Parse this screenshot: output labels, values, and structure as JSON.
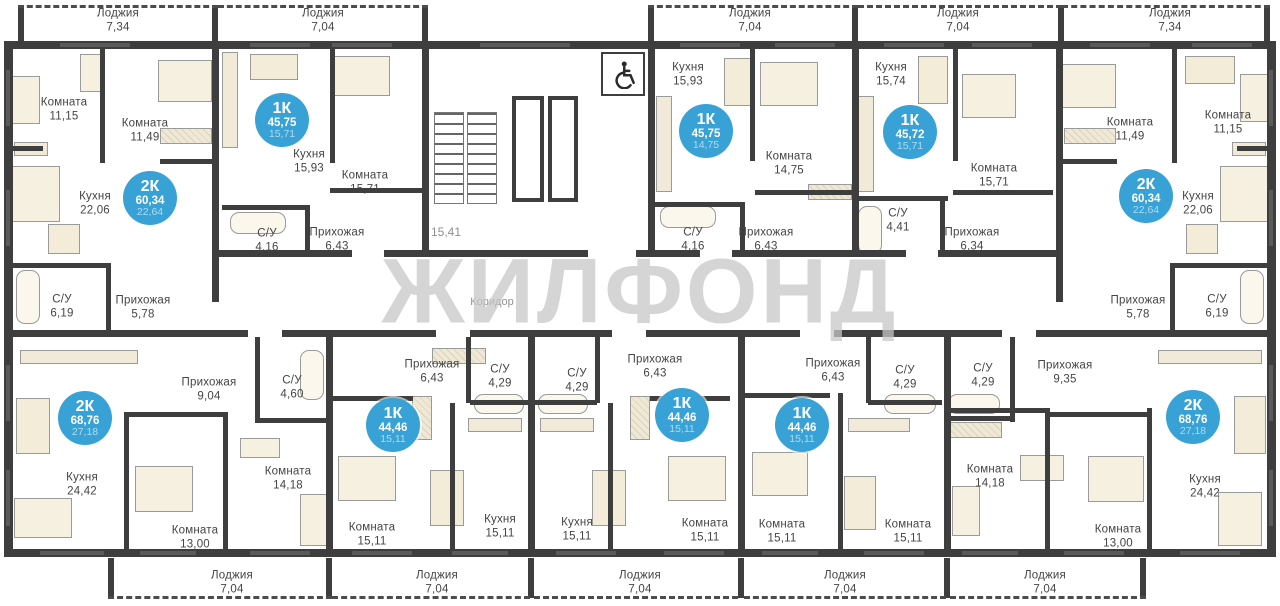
{
  "watermark": {
    "text": "ЖИЛФОНД"
  },
  "common": {
    "corridor_label": "Коридор",
    "stair_area_label": "15,41",
    "wheelchair_icon": "wheelchair-accessible"
  },
  "colors": {
    "badge_bg": "#38a2d6",
    "badge_living_text": "rgba(255,255,255,0.6)",
    "wall": "#3e3e3e",
    "label_text": "#454545",
    "furniture_fill": "#f6f0e0",
    "watermark": "#c7c7c7",
    "floor": "#ffffff"
  },
  "apartments": [
    {
      "label": "2К",
      "total": "60,34",
      "living": "22,64",
      "badge": {
        "x": 150,
        "y": 198
      },
      "loggia": {
        "name": "Лоджия",
        "area": "7,34",
        "x": 118,
        "y": 21
      },
      "rooms": [
        {
          "name": "Комната",
          "area": "11,15",
          "x": 64,
          "y": 110
        },
        {
          "name": "Комната",
          "area": "11,49",
          "x": 145,
          "y": 131
        },
        {
          "name": "Кухня",
          "area": "22,06",
          "x": 95,
          "y": 204
        },
        {
          "name": "С/У",
          "area": "6,19",
          "x": 62,
          "y": 307
        },
        {
          "name": "Прихожая",
          "area": "5,78",
          "x": 143,
          "y": 308
        }
      ]
    },
    {
      "label": "1К",
      "total": "45,75",
      "living": "15,71",
      "badge": {
        "x": 282,
        "y": 120
      },
      "loggia": {
        "name": "Лоджия",
        "area": "7,04",
        "x": 323,
        "y": 21
      },
      "rooms": [
        {
          "name": "Кухня",
          "area": "15,93",
          "x": 309,
          "y": 162
        },
        {
          "name": "Комната",
          "area": "15,71",
          "x": 365,
          "y": 183
        },
        {
          "name": "С/У",
          "area": "4,16",
          "x": 267,
          "y": 241
        },
        {
          "name": "Прихожая",
          "area": "6,43",
          "x": 337,
          "y": 240
        }
      ]
    },
    {
      "label": "1К",
      "total": "45,75",
      "living": "14,75",
      "badge": {
        "x": 706,
        "y": 131
      },
      "loggia": {
        "name": "Лоджия",
        "area": "7,04",
        "x": 750,
        "y": 21
      },
      "rooms": [
        {
          "name": "Кухня",
          "area": "15,93",
          "x": 688,
          "y": 75
        },
        {
          "name": "Комната",
          "area": "14,75",
          "x": 789,
          "y": 164
        },
        {
          "name": "С/У",
          "area": "4,16",
          "x": 693,
          "y": 240
        },
        {
          "name": "Прихожая",
          "area": "6,43",
          "x": 766,
          "y": 240
        }
      ]
    },
    {
      "label": "1К",
      "total": "45,72",
      "living": "15,71",
      "badge": {
        "x": 910,
        "y": 132
      },
      "loggia": {
        "name": "Лоджия",
        "area": "7,04",
        "x": 958,
        "y": 21
      },
      "rooms": [
        {
          "name": "Кухня",
          "area": "15,74",
          "x": 891,
          "y": 75
        },
        {
          "name": "Комната",
          "area": "15,71",
          "x": 994,
          "y": 176
        },
        {
          "name": "С/У",
          "area": "4,41",
          "x": 898,
          "y": 221
        },
        {
          "name": "Прихожая",
          "area": "6,34",
          "x": 972,
          "y": 240
        }
      ]
    },
    {
      "label": "2К",
      "total": "60,34",
      "living": "22,64",
      "badge": {
        "x": 1146,
        "y": 196
      },
      "loggia": {
        "name": "Лоджия",
        "area": "7,34",
        "x": 1170,
        "y": 21
      },
      "rooms": [
        {
          "name": "Комната",
          "area": "11,49",
          "x": 1130,
          "y": 130
        },
        {
          "name": "Комната",
          "area": "11,15",
          "x": 1228,
          "y": 123
        },
        {
          "name": "Кухня",
          "area": "22,06",
          "x": 1198,
          "y": 204
        },
        {
          "name": "Прихожая",
          "area": "5,78",
          "x": 1138,
          "y": 308
        },
        {
          "name": "С/У",
          "area": "6,19",
          "x": 1217,
          "y": 307
        }
      ]
    },
    {
      "label": "2К",
      "total": "68,76",
      "living": "27,18",
      "badge": {
        "x": 85,
        "y": 418
      },
      "loggia": {
        "name": "Лоджия",
        "area": "7,04",
        "x": 232,
        "y": 583
      },
      "rooms": [
        {
          "name": "Прихожая",
          "area": "9,04",
          "x": 209,
          "y": 390
        },
        {
          "name": "С/У",
          "area": "4,60",
          "x": 292,
          "y": 388
        },
        {
          "name": "Кухня",
          "area": "24,42",
          "x": 82,
          "y": 485
        },
        {
          "name": "Комната",
          "area": "13,00",
          "x": 195,
          "y": 538
        },
        {
          "name": "Комната",
          "area": "14,18",
          "x": 288,
          "y": 479
        }
      ]
    },
    {
      "label": "1К",
      "total": "44,46",
      "living": "15,11",
      "badge": {
        "x": 393,
        "y": 425
      },
      "loggia": {
        "name": "Лоджия",
        "area": "7,04",
        "x": 437,
        "y": 583
      },
      "rooms": [
        {
          "name": "Прихожая",
          "area": "6,43",
          "x": 432,
          "y": 372
        },
        {
          "name": "С/У",
          "area": "4,29",
          "x": 500,
          "y": 377
        },
        {
          "name": "Комната",
          "area": "15,11",
          "x": 372,
          "y": 535
        },
        {
          "name": "Кухня",
          "area": "15,11",
          "x": 500,
          "y": 527
        }
      ]
    },
    {
      "label": "1К",
      "total": "44,46",
      "living": "15,11",
      "badge": {
        "x": 682,
        "y": 415
      },
      "loggia": {
        "name": "Лоджия",
        "area": "7,04",
        "x": 640,
        "y": 583
      },
      "rooms": [
        {
          "name": "С/У",
          "area": "4,29",
          "x": 577,
          "y": 381
        },
        {
          "name": "Кухня",
          "area": "15,11",
          "x": 577,
          "y": 530
        },
        {
          "name": "Прихожая",
          "area": "6,43",
          "x": 655,
          "y": 367
        },
        {
          "name": "Комната",
          "area": "15,11",
          "x": 705,
          "y": 531
        }
      ]
    },
    {
      "label": "1К",
      "total": "44,46",
      "living": "15,11",
      "badge": {
        "x": 802,
        "y": 425
      },
      "loggia": {
        "name": "Лоджия",
        "area": "7,04",
        "x": 845,
        "y": 583
      },
      "rooms": [
        {
          "name": "Прихожая",
          "area": "6,43",
          "x": 833,
          "y": 371
        },
        {
          "name": "С/У",
          "area": "4,29",
          "x": 905,
          "y": 378
        },
        {
          "name": "Комната",
          "area": "15,11",
          "x": 782,
          "y": 532
        },
        {
          "name": "Комната",
          "area": "15,11",
          "x": 908,
          "y": 532
        }
      ]
    },
    {
      "label": "2К",
      "total": "68,76",
      "living": "27,18",
      "badge": {
        "x": 1193,
        "y": 417
      },
      "loggia": {
        "name": "Лоджия",
        "area": "7,04",
        "x": 1045,
        "y": 583
      },
      "rooms": [
        {
          "name": "С/У",
          "area": "4,29",
          "x": 983,
          "y": 376
        },
        {
          "name": "Прихожая",
          "area": "9,35",
          "x": 1065,
          "y": 373
        },
        {
          "name": "Комната",
          "area": "14,18",
          "x": 990,
          "y": 477
        },
        {
          "name": "Комната",
          "area": "13,00",
          "x": 1118,
          "y": 537
        },
        {
          "name": "Кухня",
          "area": "24,42",
          "x": 1205,
          "y": 487
        }
      ]
    }
  ],
  "furniture": [
    {
      "kind": "bed",
      "x": 12,
      "y": 76,
      "w": 28,
      "h": 48
    },
    {
      "kind": "bed",
      "x": 158,
      "y": 60,
      "w": 54,
      "h": 42
    },
    {
      "kind": "wardrobe",
      "x": 160,
      "y": 128,
      "w": 52,
      "h": 16
    },
    {
      "kind": "desk",
      "x": 80,
      "y": 54,
      "w": 22,
      "h": 38
    },
    {
      "kind": "counter",
      "x": 14,
      "y": 142,
      "w": 34,
      "h": 14
    },
    {
      "kind": "sofa",
      "x": 12,
      "y": 166,
      "w": 48,
      "h": 56
    },
    {
      "kind": "table",
      "x": 48,
      "y": 224,
      "w": 32,
      "h": 30
    },
    {
      "kind": "bath",
      "x": 16,
      "y": 270,
      "w": 24,
      "h": 54
    },
    {
      "kind": "counter",
      "x": 222,
      "y": 52,
      "w": 16,
      "h": 96
    },
    {
      "kind": "table",
      "x": 250,
      "y": 54,
      "w": 48,
      "h": 26
    },
    {
      "kind": "bed",
      "x": 332,
      "y": 56,
      "w": 58,
      "h": 40
    },
    {
      "kind": "bath",
      "x": 230,
      "y": 212,
      "w": 56,
      "h": 22
    },
    {
      "kind": "counter",
      "x": 656,
      "y": 96,
      "w": 16,
      "h": 96
    },
    {
      "kind": "table",
      "x": 724,
      "y": 58,
      "w": 30,
      "h": 48
    },
    {
      "kind": "bed",
      "x": 760,
      "y": 62,
      "w": 58,
      "h": 44
    },
    {
      "kind": "wardrobe",
      "x": 808,
      "y": 184,
      "w": 44,
      "h": 16
    },
    {
      "kind": "bath",
      "x": 660,
      "y": 206,
      "w": 56,
      "h": 22
    },
    {
      "kind": "counter",
      "x": 858,
      "y": 96,
      "w": 16,
      "h": 96
    },
    {
      "kind": "table",
      "x": 918,
      "y": 56,
      "w": 30,
      "h": 48
    },
    {
      "kind": "bed",
      "x": 962,
      "y": 74,
      "w": 54,
      "h": 44
    },
    {
      "kind": "bath",
      "x": 858,
      "y": 206,
      "w": 24,
      "h": 48
    },
    {
      "kind": "bed",
      "x": 1062,
      "y": 64,
      "w": 54,
      "h": 44
    },
    {
      "kind": "wardrobe",
      "x": 1064,
      "y": 128,
      "w": 52,
      "h": 16
    },
    {
      "kind": "bed",
      "x": 1240,
      "y": 74,
      "w": 28,
      "h": 48
    },
    {
      "kind": "table",
      "x": 1185,
      "y": 56,
      "w": 50,
      "h": 28
    },
    {
      "kind": "counter",
      "x": 1232,
      "y": 142,
      "w": 34,
      "h": 14
    },
    {
      "kind": "sofa",
      "x": 1220,
      "y": 166,
      "w": 48,
      "h": 56
    },
    {
      "kind": "table",
      "x": 1186,
      "y": 224,
      "w": 32,
      "h": 30
    },
    {
      "kind": "bath",
      "x": 1240,
      "y": 270,
      "w": 24,
      "h": 54
    },
    {
      "kind": "counter",
      "x": 20,
      "y": 350,
      "w": 118,
      "h": 14
    },
    {
      "kind": "table",
      "x": 16,
      "y": 398,
      "w": 34,
      "h": 56
    },
    {
      "kind": "sofa",
      "x": 14,
      "y": 498,
      "w": 58,
      "h": 40
    },
    {
      "kind": "bed",
      "x": 135,
      "y": 466,
      "w": 58,
      "h": 46
    },
    {
      "kind": "desk",
      "x": 240,
      "y": 438,
      "w": 40,
      "h": 20
    },
    {
      "kind": "bed",
      "x": 300,
      "y": 494,
      "w": 28,
      "h": 52
    },
    {
      "kind": "bath",
      "x": 300,
      "y": 350,
      "w": 24,
      "h": 50
    },
    {
      "kind": "wardrobe",
      "x": 432,
      "y": 348,
      "w": 54,
      "h": 16
    },
    {
      "kind": "wardrobe",
      "x": 412,
      "y": 396,
      "w": 20,
      "h": 44
    },
    {
      "kind": "bed",
      "x": 338,
      "y": 456,
      "w": 58,
      "h": 45
    },
    {
      "kind": "table",
      "x": 430,
      "y": 470,
      "w": 34,
      "h": 56
    },
    {
      "kind": "bath",
      "x": 474,
      "y": 394,
      "w": 50,
      "h": 20
    },
    {
      "kind": "counter",
      "x": 468,
      "y": 418,
      "w": 54,
      "h": 14
    },
    {
      "kind": "bath",
      "x": 538,
      "y": 394,
      "w": 50,
      "h": 20
    },
    {
      "kind": "counter",
      "x": 540,
      "y": 418,
      "w": 54,
      "h": 14
    },
    {
      "kind": "table",
      "x": 592,
      "y": 470,
      "w": 34,
      "h": 56
    },
    {
      "kind": "wardrobe",
      "x": 630,
      "y": 396,
      "w": 20,
      "h": 44
    },
    {
      "kind": "bed",
      "x": 668,
      "y": 456,
      "w": 58,
      "h": 45
    },
    {
      "kind": "bed",
      "x": 752,
      "y": 452,
      "w": 56,
      "h": 44
    },
    {
      "kind": "bath",
      "x": 884,
      "y": 394,
      "w": 52,
      "h": 20
    },
    {
      "kind": "counter",
      "x": 848,
      "y": 418,
      "w": 62,
      "h": 14
    },
    {
      "kind": "table",
      "x": 844,
      "y": 476,
      "w": 32,
      "h": 54
    },
    {
      "kind": "bath",
      "x": 948,
      "y": 394,
      "w": 52,
      "h": 20
    },
    {
      "kind": "wardrobe",
      "x": 950,
      "y": 422,
      "w": 52,
      "h": 16
    },
    {
      "kind": "desk",
      "x": 1020,
      "y": 455,
      "w": 44,
      "h": 26
    },
    {
      "kind": "sofa",
      "x": 952,
      "y": 486,
      "w": 28,
      "h": 50
    },
    {
      "kind": "bed",
      "x": 1088,
      "y": 456,
      "w": 56,
      "h": 46
    },
    {
      "kind": "counter",
      "x": 1158,
      "y": 350,
      "w": 104,
      "h": 14
    },
    {
      "kind": "table",
      "x": 1234,
      "y": 396,
      "w": 32,
      "h": 58
    },
    {
      "kind": "sofa",
      "x": 1218,
      "y": 492,
      "w": 44,
      "h": 54
    }
  ]
}
